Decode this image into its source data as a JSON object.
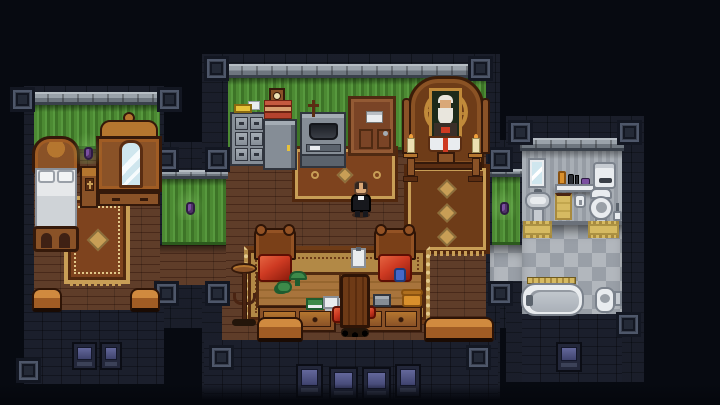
{
  "scene": {
    "title": "top-down pixel-art mansion interior at night",
    "rooms": [
      {
        "name": "bedroom",
        "wall": "green striped wallpaper",
        "floor": "dark wood planks",
        "items": [
          "ornate-bed",
          "pillows",
          "footboard",
          "nightstand-with-cross",
          "wardrobe-with-mirror",
          "wall-sconce",
          "ornate-rug",
          "bench-left",
          "bench-right",
          "facade-windows"
        ]
      },
      {
        "name": "study-chapel",
        "wall": "green striped wallpaper",
        "floor": "dark wood planks",
        "items": [
          "file-cabinet",
          "folder-on-cabinet",
          "paper-tray-stack",
          "wall-clock",
          "photocopier",
          "wall-cross",
          "wooden-door",
          "door-sign",
          "ancestor-shrine",
          "elder-portrait",
          "open-bible-with-red-bookmark",
          "candle-stand-left",
          "candle-stand-right",
          "shrine-rug",
          "center-rug",
          "desk-rug",
          "partner-desk",
          "desk-chair-left",
          "desk-chair-right",
          "desk-chair-front",
          "banker-lamp",
          "teapot",
          "green-ledger",
          "paper-stack",
          "clipboard",
          "blue-jar",
          "typewriter",
          "telephone",
          "hat-stand",
          "bench-left",
          "bench-right",
          "facade-windows"
        ]
      },
      {
        "name": "bathroom",
        "wall": "grey tile",
        "floor": "checkered tile",
        "items": [
          "wall-mirror",
          "shelf",
          "toiletry-bottles",
          "cistern",
          "pedestal-sink",
          "hand-towel",
          "toilet-paper",
          "toilet",
          "toilet-brush",
          "bath-mat-left",
          "bath-mat-right",
          "towel-rail",
          "bathtub",
          "bidet",
          "facade-window"
        ]
      },
      {
        "name": "corridor-west",
        "items": [
          "wall-sconce"
        ]
      },
      {
        "name": "corridor-east",
        "items": [
          "wall-sconce"
        ]
      }
    ],
    "characters": [
      {
        "name": "priest",
        "appearance": "balding man in black cassock with white clerical collar",
        "location": "study-chapel"
      }
    ]
  },
  "palette": {
    "bg": "#070a11",
    "ext0": "#0e111a",
    "ext1": "#161a26",
    "fac0": "#12151f",
    "fac1": "#1b1f2c",
    "capA": "#9aa2aa",
    "capB": "#6e767f",
    "capT": "#b6bdc3",
    "capD": "#3a414b",
    "g0": "#2c5a1d",
    "g1": "#4c8a33",
    "g2": "#57993e",
    "g3": "#3d7427",
    "w0": "#48291a",
    "w1": "#5f3d29",
    "t0": "#6b717a",
    "t1": "#a8aeb5",
    "t2": "#969ca4",
    "c1": "#b2b7bd",
    "c2": "#999fa7",
    "twF": "#3a4150",
    "twI": "#242a37",
    "twB": "#131722",
    "twH": "#4e576a",
    "wfr": "#23273a",
    "wg1": "#63679b",
    "wg2": "#3f436e",
    "furn": "#8a5227",
    "furnL": "#b5762f",
    "furnD": "#5a2d12",
    "outline": "#35190a",
    "rugGold": "#c89e56",
    "rugRed": "#7e431e",
    "rugDeep": "#52280e",
    "rugTan": "#b28946",
    "rugBrn": "#6e3c18",
    "rugCream": "#e2c88a",
    "metal": "#858d96",
    "metalL": "#a4acb4",
    "metalD": "#5b636d",
    "metalLine": "#30353e",
    "white": "#e9ecef",
    "whiteDim": "#c6cbd1",
    "fixLine": "#7b828c",
    "mat": "#d6ba62",
    "matD": "#a88a3e",
    "purple": "#7b4fa0",
    "purpleD": "#2e1b42",
    "glow": "rgba(134,200,104,0.45)",
    "red": "#ce3a22",
    "redD": "#8c1b0c",
    "skin": "#d9a878",
    "hairD": "#33261f",
    "whiteHair": "#e9e6dd",
    "black": "#17181d",
    "candle": "#ece0b2",
    "flame": "#f0a03a",
    "orange": "#d9902c",
    "folder": "#e8c23a",
    "greenItem": "#3d8a4a",
    "greenDeep": "#1f5c2f",
    "blue": "#4668c8",
    "door": "#7a4426",
    "doorD": "#4f2a12",
    "glass": "#ddeef4",
    "mirror": "#cfe6ee"
  }
}
